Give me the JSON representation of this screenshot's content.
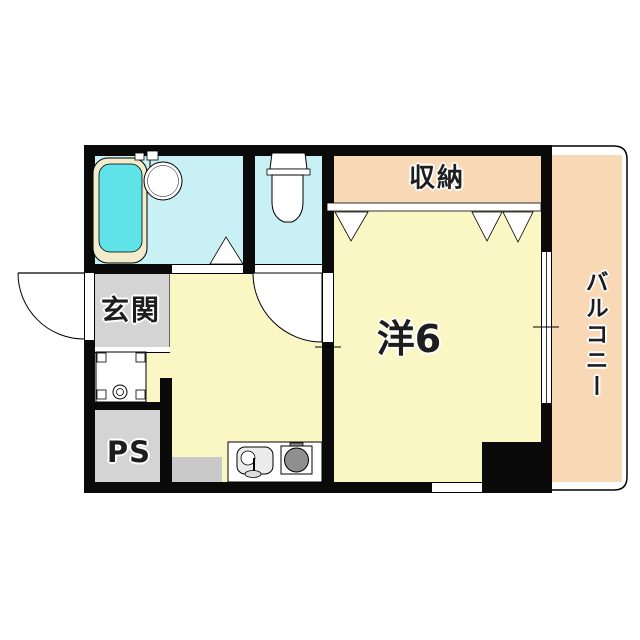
{
  "title": "1K apartment floor plan",
  "labels": {
    "closet": "収納",
    "balcony": "バルコニー",
    "entrance": "玄関",
    "pipe_space": "PS",
    "main_room": "洋6"
  },
  "colors": {
    "bg": "#FFFFFF",
    "wall": "#0A0A0A",
    "room": "#FBF7C5",
    "floor_wet": "#C9F0F4",
    "water": "#5FE2E8",
    "cream": "#F0ECCC",
    "peach": "#F8D8B5",
    "gray": "#D4D4D4",
    "gray_dark": "#C9C9C9",
    "sink": "#ECECEC",
    "burner": "#8F8F8F",
    "text": "#1D1D1D",
    "line": "#000000"
  },
  "fixtures": {
    "bathtub": "bathtub-icon",
    "washbasin": "washbasin-icon",
    "bath_faucet": "faucet-icon",
    "toilet": "toilet-icon",
    "washer_pan": "washer-pan-icon",
    "kitchen_sink": "kitchen-sink-icon",
    "stove": "stove-burner-icon",
    "entrance_door": "entrance-door-swing",
    "room_door": "room-door-swing",
    "bath_door": "folding-door-triangle",
    "closet_doors": "sliding-door-triangles",
    "balcony_window": "sliding-window",
    "bottom_window": "wall-window"
  }
}
